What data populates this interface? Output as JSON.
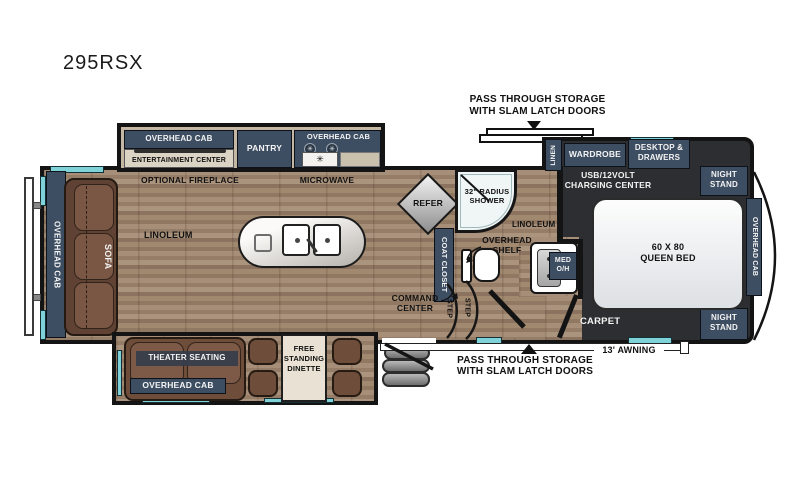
{
  "title": "295RSX",
  "callouts": {
    "pass_through_top": {
      "line1": "PASS THROUGH STORAGE",
      "line2": "WITH SLAM LATCH DOORS"
    },
    "pass_through_bottom": {
      "line1": "PASS THROUGH STORAGE",
      "line2": "WITH SLAM LATCH DOORS"
    },
    "awning": "13' AWNING"
  },
  "living_area": {
    "overhead_cab_rear": "OVERHEAD CAB",
    "sofa": "SOFA",
    "entertainment_overhead": "OVERHEAD CAB",
    "entertainment_center": "ENTERTAINMENT CENTER",
    "optional_fireplace": "OPTIONAL FIREPLACE",
    "pantry": "PANTRY",
    "kitchen_overhead": "OVERHEAD CAB",
    "microwave": "MICROWAVE",
    "linoleum": "LINOLEUM",
    "refer": "REFER",
    "command_center": {
      "line1": "COMMAND",
      "line2": "CENTER"
    },
    "theater_seating": "THEATER SEATING",
    "theater_overhead": "OVERHEAD CAB",
    "dinette": {
      "line1": "FREE",
      "line2": "STANDING",
      "line3": "DINETTE"
    }
  },
  "bathroom": {
    "shower": {
      "line1": "32\" RADIUS",
      "line2": "SHOWER"
    },
    "coat_closet": "COAT CLOSET",
    "linoleum": "LINOLEUM",
    "overhead_shelf": {
      "line1": "OVERHEAD",
      "line2": "SHELF"
    },
    "med_oh": {
      "line1": "MED",
      "line2": "O/H"
    },
    "step1": "STEP",
    "step2": "STEP"
  },
  "bedroom": {
    "linen": "LINEN",
    "wardrobe": "WARDROBE",
    "desktop_drawers": {
      "line1": "DESKTOP &",
      "line2": "DRAWERS"
    },
    "usb_charging": {
      "line1": "USB/12VOLT",
      "line2": "CHARGING CENTER"
    },
    "night_stand_top": {
      "line1": "NIGHT",
      "line2": "STAND"
    },
    "night_stand_bottom": {
      "line1": "NIGHT",
      "line2": "STAND"
    },
    "queen_bed": {
      "line1": "60 X 80",
      "line2": "QUEEN BED"
    },
    "overhead_cab": "OVERHEAD CAB",
    "carpet": "CARPET"
  },
  "icons": {
    "burner": "✳"
  },
  "colors": {
    "cabinet_navy": "#3e4e62",
    "wood_floor": "#9f8873",
    "carpet_dark": "#2c2e31",
    "window_cyan": "#7fd2d8",
    "wall_black": "#141414"
  }
}
